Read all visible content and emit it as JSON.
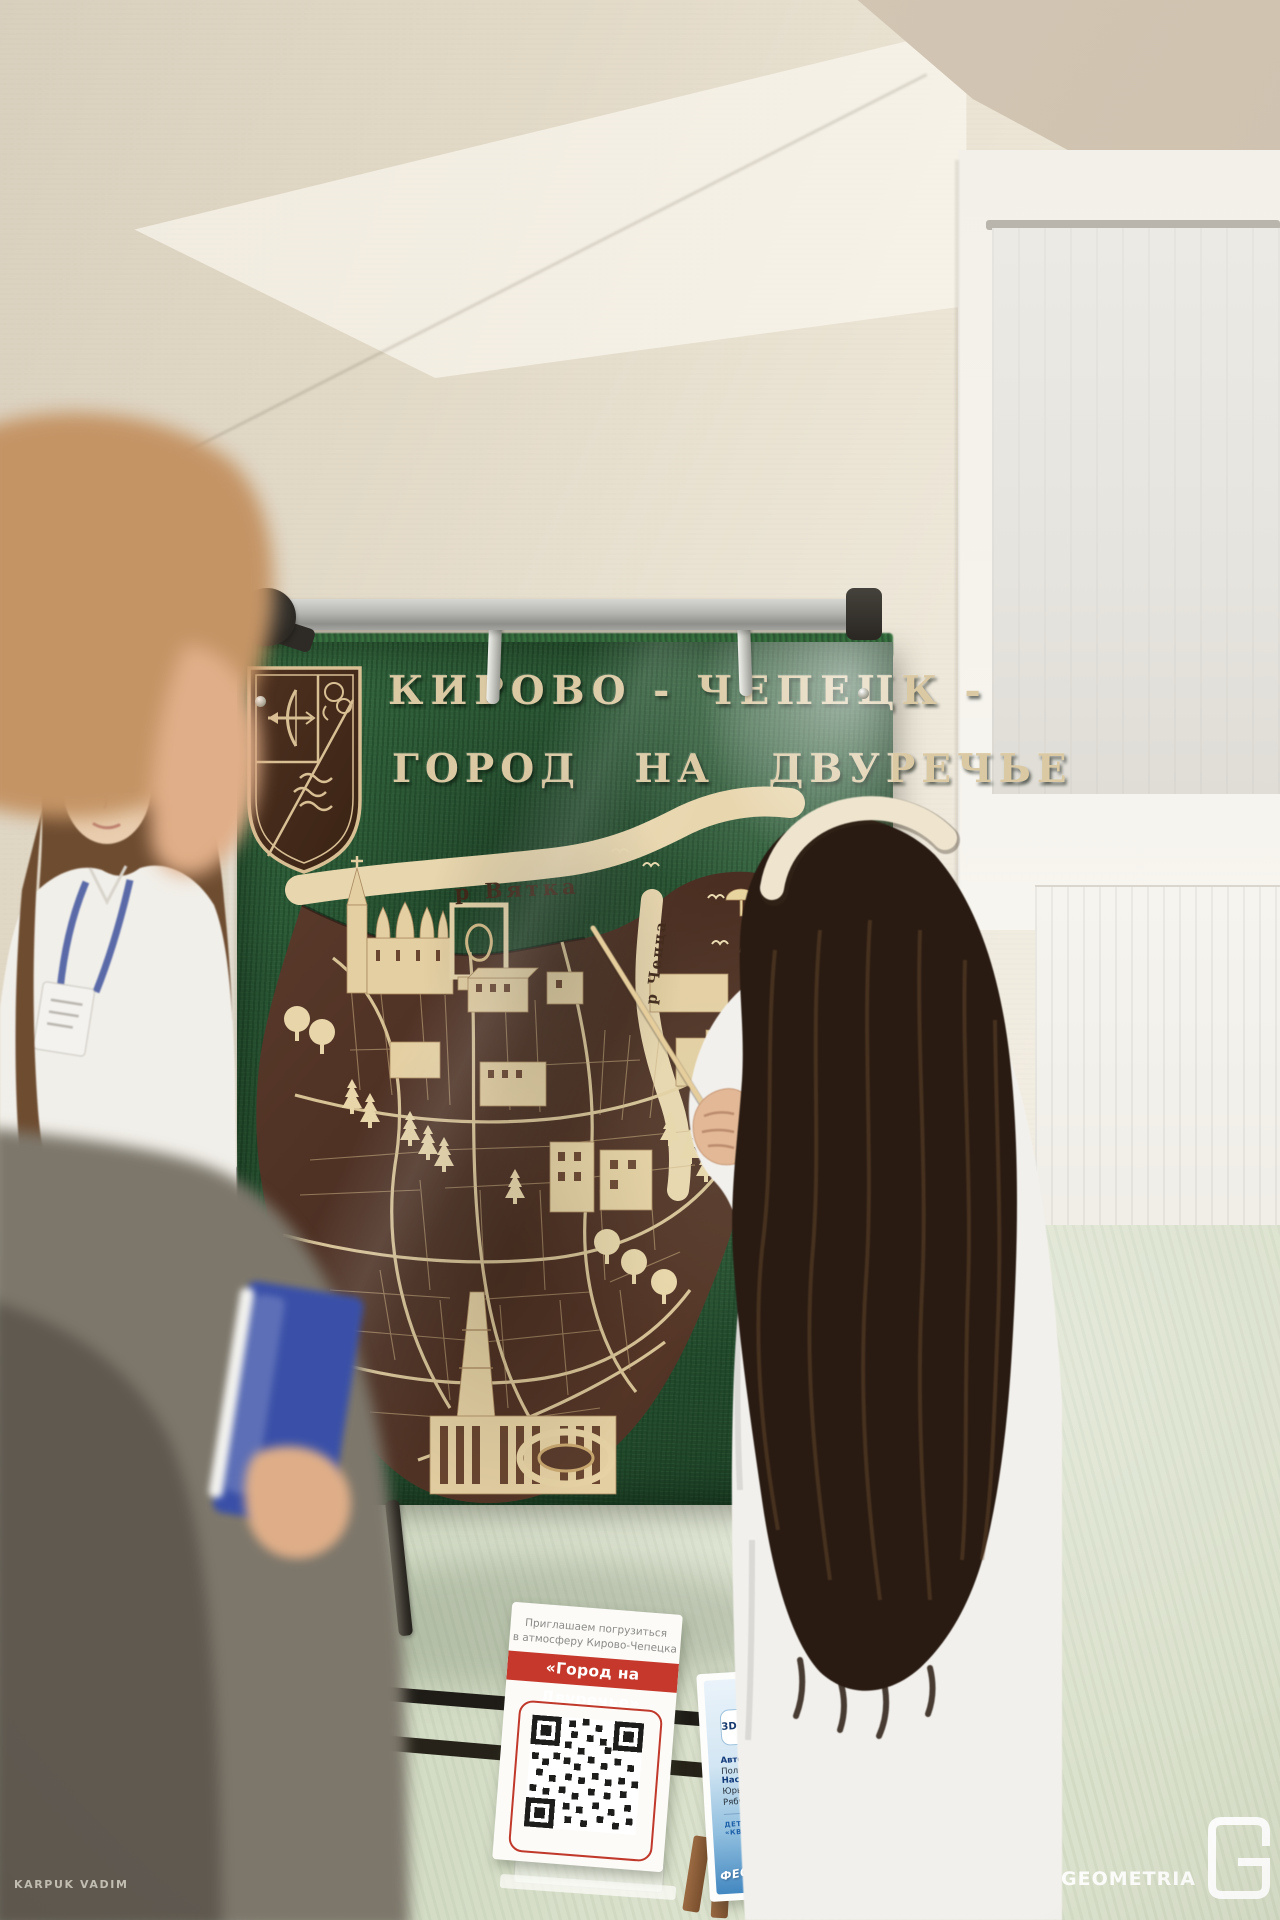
{
  "board": {
    "title_line1": "КИРОВО - ЧЕПЕЦК -",
    "title_line2": "ГОРОД НА ДВУРЕЧЬЕ",
    "river_top_label": "р Вятка",
    "river_right_label": "р Чепца"
  },
  "qr_sign": {
    "invite_line1": "Приглашаем погрузиться",
    "invite_line2": "в атмосферу  Кирово-Чепецка",
    "banner": "«Город на Двуречье»"
  },
  "info_card": {
    "title": "3D-КАРТА «ГОРОД НА ДВУРЕЧЬЕ»",
    "authors_label": "Авторы:",
    "authors_text": " Широков Яков, Головина Полина",
    "mentors_label": "Наставники:",
    "mentors_text": " Ширяева Галина Юрьевна, Обухов П. Михайлович, Рябчук Даниил Аксентьевич",
    "org_line": "ДЕТСКИЙ ТЕХНОПАРК «КВАНТОРИУМ» • КИРОВ",
    "festival_line": "ФЕСТИВАЛЬ ИДЕЙ И ТЕХНОЛОГИЙ"
  },
  "watermark": {
    "photographer": "KARPUK VADIM",
    "brand": "GEOMETRIA"
  },
  "colors": {
    "banner_red": "#c5382b",
    "card_blue": "#4388c1",
    "board_green": "#2b5836",
    "map_wood_dark": "#4e3226",
    "map_wood_light": "#e4cfa2"
  }
}
